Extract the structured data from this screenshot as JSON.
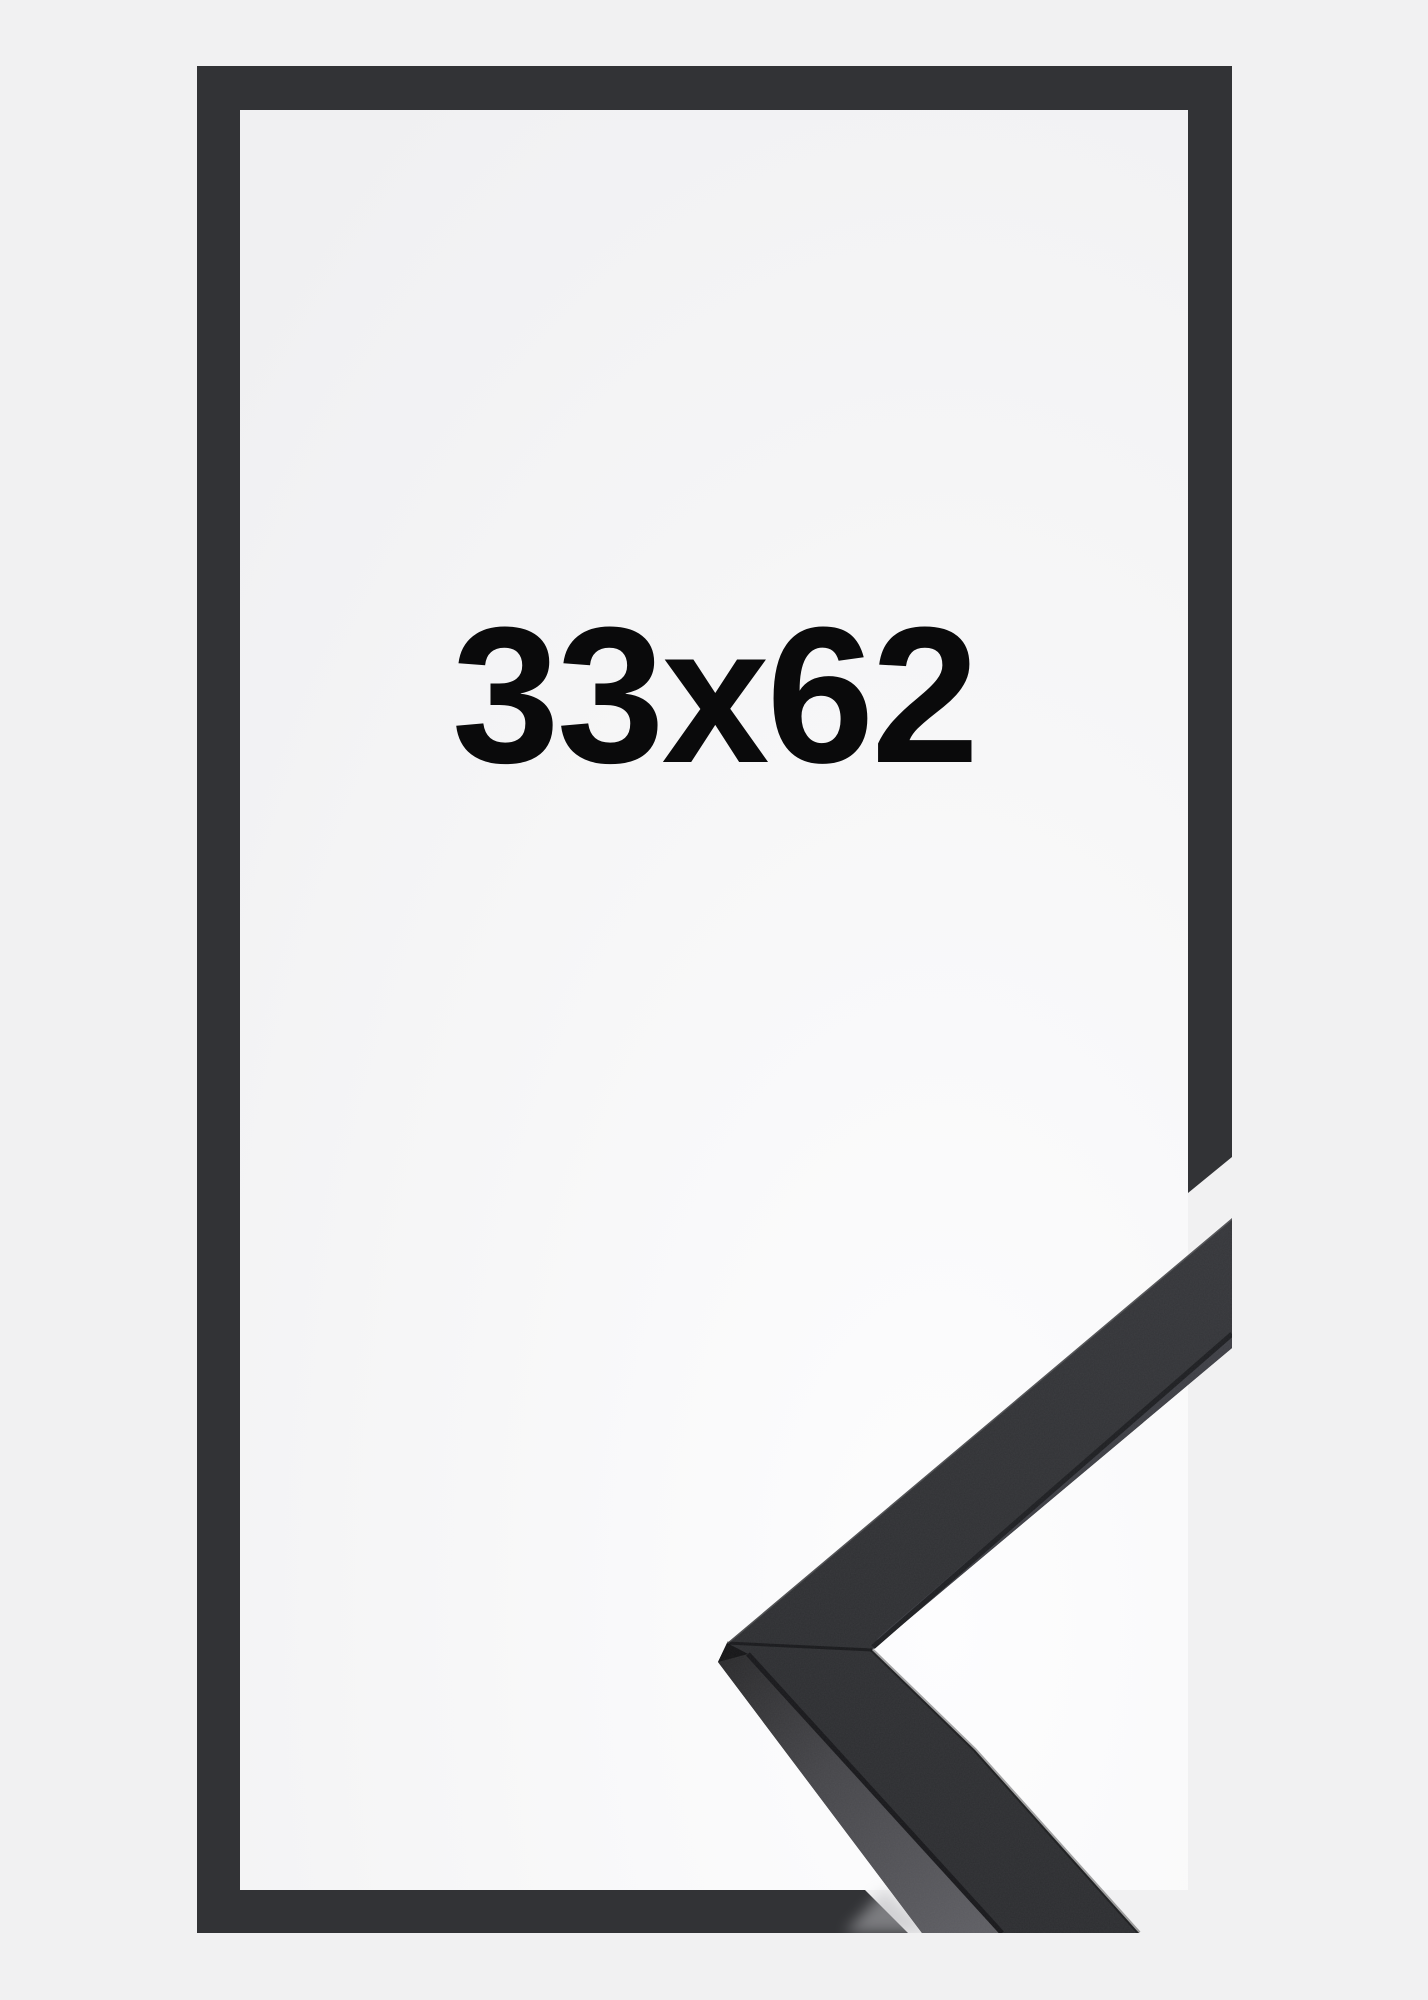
{
  "image": {
    "type": "product-photo",
    "subject": "black picture frame with mitred corner profile sample",
    "size_label": "33x62"
  },
  "colors": {
    "background": "#f1f1f2",
    "frame_outline": "#323336",
    "moulding_face": "#303134",
    "moulding_front_edge": "#3d3e44",
    "moulding_side_face": "#4a4a4e",
    "moulding_dark_edge": "#1d1e21",
    "label_text": "#0a0a0b"
  }
}
